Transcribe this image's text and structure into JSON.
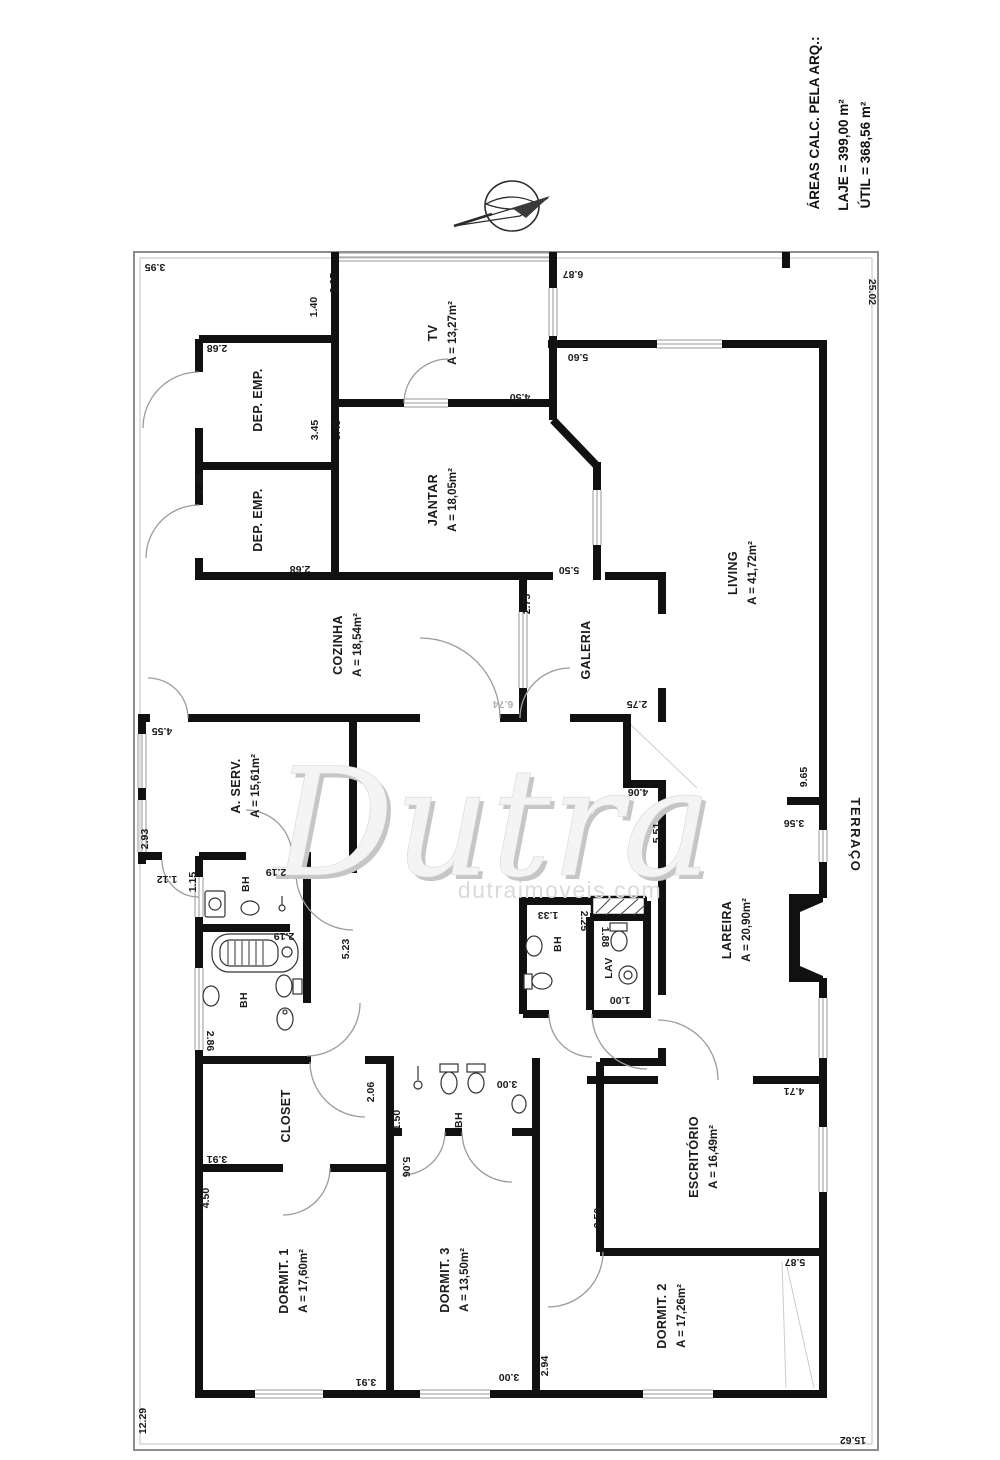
{
  "info_panel": {
    "heading": "ÁREAS CALC. PELA ARQ.:",
    "laje": "LAJE = 399,00 m²",
    "util": "ÚTIL = 368,56 m²"
  },
  "watermark": {
    "brand": "Dutra",
    "domain": "dutraimoveis.com"
  },
  "compass": {
    "name": "north-arrow"
  },
  "colors": {
    "wall": "#111111",
    "boundary": "#8d8d8d",
    "window": "#9a9a9a",
    "dim_text": "#1a1a1a",
    "muted_dim": "#b0b0b0",
    "door_arc": "#9b9b9b",
    "watermark_front": "#f4f4f4",
    "watermark_shadow": "#c6c6c6"
  },
  "rooms": [
    {
      "id": "dep-emp-1",
      "name": "DEP. EMP.",
      "x": 262,
      "y": 400
    },
    {
      "id": "dep-emp-2",
      "name": "DEP. EMP.",
      "x": 262,
      "y": 520
    },
    {
      "id": "tv",
      "name": "TV",
      "area": "A = 13,27m²",
      "x": 437,
      "y": 333
    },
    {
      "id": "jantar",
      "name": "JANTAR",
      "area": "A = 18,05m²",
      "x": 437,
      "y": 500
    },
    {
      "id": "cozinha",
      "name": "COZINHA",
      "area": "A = 18,54m²",
      "x": 342,
      "y": 645
    },
    {
      "id": "galeria",
      "name": "GALERIA",
      "x": 590,
      "y": 650
    },
    {
      "id": "living",
      "name": "LIVING",
      "area": "A = 41,72m²",
      "x": 737,
      "y": 573
    },
    {
      "id": "a-serv",
      "name": "A. SERV.",
      "area": "A = 15,61m²",
      "x": 240,
      "y": 786
    },
    {
      "id": "lareira",
      "name": "LAREIRA",
      "area": "A = 20,90m²",
      "x": 731,
      "y": 930
    },
    {
      "id": "bh-emp",
      "name": "BH",
      "x": 249,
      "y": 884,
      "size": 10.5
    },
    {
      "id": "bh-master",
      "name": "BH",
      "x": 247,
      "y": 1000,
      "size": 10.5
    },
    {
      "id": "bh-central",
      "name": "BH",
      "x": 561,
      "y": 944,
      "size": 10.5
    },
    {
      "id": "lav",
      "name": "LAV",
      "x": 612,
      "y": 968,
      "size": 10.5
    },
    {
      "id": "closet",
      "name": "CLOSET",
      "x": 290,
      "y": 1116
    },
    {
      "id": "bh-dorm",
      "name": "BH",
      "x": 462,
      "y": 1120,
      "size": 10.5
    },
    {
      "id": "dormit-1",
      "name": "DORMIT. 1",
      "area": "A = 17,60m²",
      "x": 288,
      "y": 1281
    },
    {
      "id": "dormit-3",
      "name": "DORMIT. 3",
      "area": "A = 13,50m²",
      "x": 449,
      "y": 1280
    },
    {
      "id": "dormit-2",
      "name": "DORMIT. 2",
      "area": "A = 17,26m²",
      "x": 666,
      "y": 1316
    },
    {
      "id": "escritorio",
      "name": "ESCRITÓRIO",
      "area": "A = 16,49m²",
      "x": 698,
      "y": 1157
    },
    {
      "id": "terraco",
      "name": "TERRAÇO",
      "x": 851,
      "y": 835,
      "rot": 90,
      "size": 13,
      "ls": 1.5
    }
  ],
  "dims": [
    [
      "3.95",
      155,
      264,
      180
    ],
    [
      "2.95",
      337,
      283,
      -90
    ],
    [
      "1.40",
      317,
      307,
      -90
    ],
    [
      "2.68",
      217,
      345,
      180
    ],
    [
      "3.45",
      318,
      430,
      -90
    ],
    [
      "3.45",
      340,
      430,
      -90
    ],
    [
      "2.45",
      203,
      484,
      -90
    ],
    [
      "2.68",
      300,
      566,
      180
    ],
    [
      "4.50",
      520,
      394,
      180
    ],
    [
      "6.87",
      573,
      271,
      180
    ],
    [
      "5.60",
      578,
      354,
      180
    ],
    [
      "25.02",
      869,
      292,
      90
    ],
    [
      "5.50",
      569,
      567,
      180
    ],
    [
      "2.75",
      530,
      604,
      -90
    ],
    [
      "2.75",
      637,
      701,
      180
    ],
    [
      "5.51",
      660,
      833,
      -90
    ],
    [
      "4.06",
      638,
      789,
      180
    ],
    [
      "9.65",
      807,
      777,
      -90
    ],
    [
      "3.56",
      794,
      820,
      180
    ],
    [
      "4.55",
      162,
      728,
      180
    ],
    [
      "2.93",
      148,
      839,
      -90
    ],
    [
      "1.12",
      167,
      876,
      180
    ],
    [
      "1.15",
      196,
      882,
      -90
    ],
    [
      "2.19",
      276,
      869,
      180
    ],
    [
      "2.19",
      284,
      933,
      180
    ],
    [
      "5.23",
      349,
      949,
      -90
    ],
    [
      "2.86",
      207,
      1041,
      90
    ],
    [
      "1.33",
      548,
      912,
      180
    ],
    [
      "2.25",
      581,
      921,
      90
    ],
    [
      "1.88",
      602,
      937,
      90
    ],
    [
      "1.00",
      620,
      997,
      180
    ],
    [
      "2.06",
      374,
      1092,
      -90
    ],
    [
      "3.91",
      217,
      1156,
      180
    ],
    [
      "1.50",
      400,
      1120,
      -90
    ],
    [
      "3.00",
      507,
      1081,
      180
    ],
    [
      "5.06",
      403,
      1167,
      90
    ],
    [
      "4.50",
      209,
      1198,
      -90
    ],
    [
      "3.91",
      366,
      1379,
      180
    ],
    [
      "3.00",
      509,
      1374,
      180
    ],
    [
      "2.94",
      548,
      1366,
      -90
    ],
    [
      "3.50",
      601,
      1218,
      -90
    ],
    [
      "4.71",
      794,
      1088,
      180
    ],
    [
      "5.87",
      795,
      1259,
      180
    ],
    [
      "12.29",
      146,
      1421,
      -90
    ],
    [
      "15.62",
      853,
      1437,
      180
    ]
  ],
  "muted_dims": [
    [
      "6.74",
      503,
      701,
      180
    ]
  ]
}
